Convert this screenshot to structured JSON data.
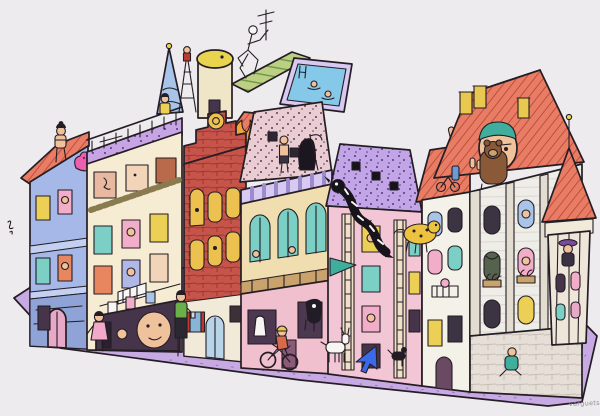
{
  "artwork": {
    "title": "Isometric townhouse block with many tiny characters",
    "signature": "varguets",
    "background_color": "#edebee",
    "street_color": "#c7aae3",
    "outline_color": "#241d24"
  },
  "palette": {
    "periwinkle": "#a5b8e8",
    "periwinkle_base": "#8fa3d6",
    "periwinkle_band": "#c3d0f2",
    "cream": "#f5ecd3",
    "cream_dark": "#e0cf9f",
    "terrace_purple": "#c7a4e3",
    "brick": "#c6544a",
    "brick_line": "#97392f",
    "roof_salmon": "#e87c64",
    "roof_stripe": "#b14531",
    "mansard_pink": "#e9cdd2",
    "speck_dark": "#5f3c4e",
    "awning": "#d8c9f2",
    "awning_stripe": "#9d8ccc",
    "arcade_gold": "#edc14f",
    "glass_teal": "#7ccfc5",
    "pink": "#f3c6d6",
    "roof_purple": "#c2a5e6",
    "purple_speck": "#54377c",
    "white_bldg": "#f4f1e8",
    "gray_bldg": "#eeede8",
    "pilaster": "#e2ddd0",
    "stone": "#e6dfd8",
    "stone_line": "#c6beb6",
    "pool_blue": "#85c8e8",
    "pool_rim": "#d8c9f2",
    "deck_green": "#bccf82",
    "deck_stripe": "#6f9c4a",
    "tower_cream": "#efe6c8",
    "dome_yellow": "#e8d44e",
    "spire_blue": "#a8c4e8",
    "flame_orange": "#f2a43a",
    "flame_yellow": "#f6d44e",
    "skin": "#f0c29c",
    "window_dark": "#46354a",
    "shop_dark": "#4c3850",
    "teal_deep": "#3fae9c",
    "blue_accent": "#3a6ae8",
    "red_accent": "#c0392f",
    "yellow_accent": "#eccf55",
    "wood": "#c9a36b",
    "bear_brown": "#8a5a38",
    "blue_shirt": "#4a7ac8",
    "green_shirt": "#6ab04a",
    "magenta": "#ec5fb0",
    "white": "#f8f6f2"
  },
  "buildings": [
    {
      "name": "periwinkle-apartments",
      "facade": "periwinkle",
      "roof": "roof_salmon",
      "details": [
        "red sloped roof edge",
        "two cornice bands",
        "stone base",
        "pink arched door",
        "sunbathing woman on parapet",
        "pink blob creature"
      ]
    },
    {
      "name": "cream-ornate-house",
      "facade": "cream",
      "roof": "terrace_purple",
      "details": [
        "purple rooftop terrace with balustrade",
        "attic face windows",
        "ornament frieze",
        "balcony",
        "laundry line",
        "giant face in ground-floor room"
      ]
    },
    {
      "name": "brick-stepped-gable-house",
      "facade": "brick",
      "roof": "roof_salmon",
      "details": [
        "dutch stepped gable",
        "gold medallion",
        "gold arched windows",
        "white ground floor",
        "fire flames on roof"
      ]
    },
    {
      "name": "bathhouse-arcade",
      "facade": "arcade_gold",
      "roof": "mansard_pink",
      "details": [
        "speckled pink mansard",
        "grim reaper",
        "man in shorts",
        "striped lavender awning",
        "teal stained-glass arches",
        "pink shopfronts",
        "hanging cow"
      ]
    },
    {
      "name": "pink-ladder-house",
      "facade": "pink",
      "roof": "roof_purple",
      "details": [
        "speckled purple roof with black windows",
        "black-and-white dragon climbing",
        "two ladders",
        "teal pennant"
      ]
    },
    {
      "name": "white-narrow-house",
      "facade": "white_bldg",
      "roof": "roof_salmon",
      "details": [
        "giant hand out of roof",
        "kid on tricycle on roof",
        "leopard creature",
        "balcony baby"
      ]
    },
    {
      "name": "grand-stone-house",
      "facade": "gray_bldg",
      "roof": "roof_salmon",
      "details": [
        "big hip roof",
        "giant head with teal cap",
        "bear on roof",
        "yellow chimneys",
        "arched windows with plants",
        "stone block base",
        "corner turret with conical roof",
        "turret watcher with purple hat"
      ]
    }
  ],
  "rooftop_objects": [
    "church-spire",
    "lattice-mast",
    "water-tower",
    "green-striped-deck",
    "dancing-skeleton",
    "tv-antenna",
    "rooftop-pool",
    "swimmers"
  ],
  "street_figures": [
    "kid-in-pink",
    "man-in-green",
    "cyclist",
    "white-goat",
    "blue-cursor-arrow",
    "black-dog",
    "sitting-teal-figure"
  ],
  "ground": {
    "platform_shape": "isometric parallelogram sidewalk",
    "color_key": "street"
  }
}
